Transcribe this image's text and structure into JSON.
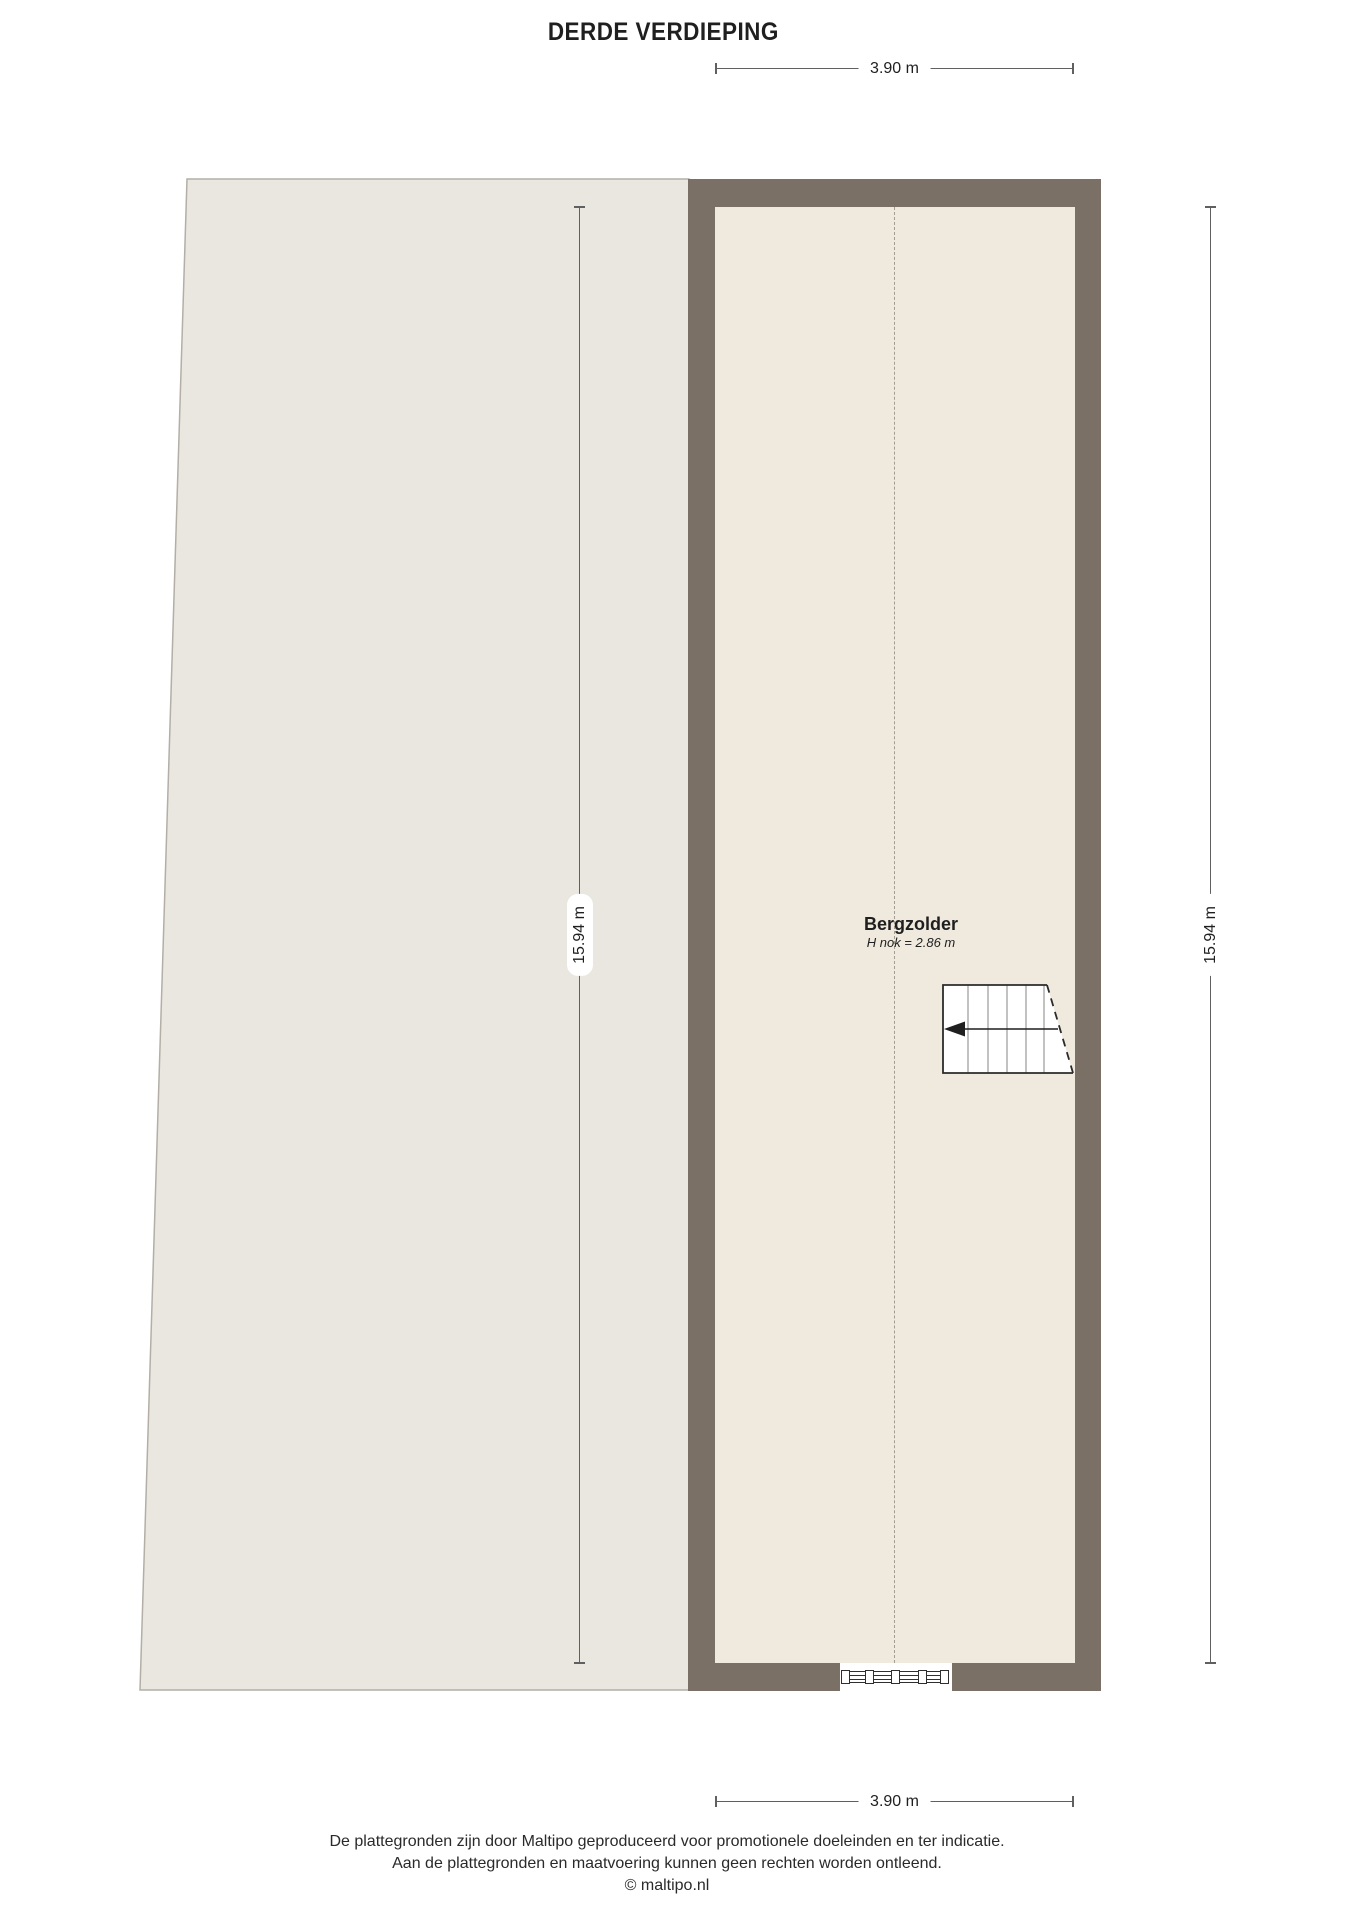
{
  "title": "DERDE VERDIEPING",
  "dimensions": {
    "top_width": "3.90 m",
    "bottom_width": "3.90 m",
    "left_height": "15.94 m",
    "right_height": "15.94 m"
  },
  "room": {
    "name": "Bergzolder",
    "height_note": "H nok = 2.86 m"
  },
  "footer": {
    "line1": "De plattegronden zijn door Maltipo geproduceerd voor promotionele doeleinden en ter indicatie.",
    "line2": "Aan de plattegronden en maatvoering kunnen geen rechten worden ontleend.",
    "line3": "© maltipo.nl"
  },
  "colors": {
    "wall": "#7b7066",
    "room_fill": "#f0e9de",
    "left_area_fill": "#eae7e0",
    "left_area_stroke": "#b3afa6",
    "dim": "#606060",
    "text": "#1f1f1f",
    "ridge": "#a39c90",
    "stair_stroke": "#2b2b2b",
    "tread": "#9a9a9a",
    "window_stroke": "#2f2f2f"
  }
}
